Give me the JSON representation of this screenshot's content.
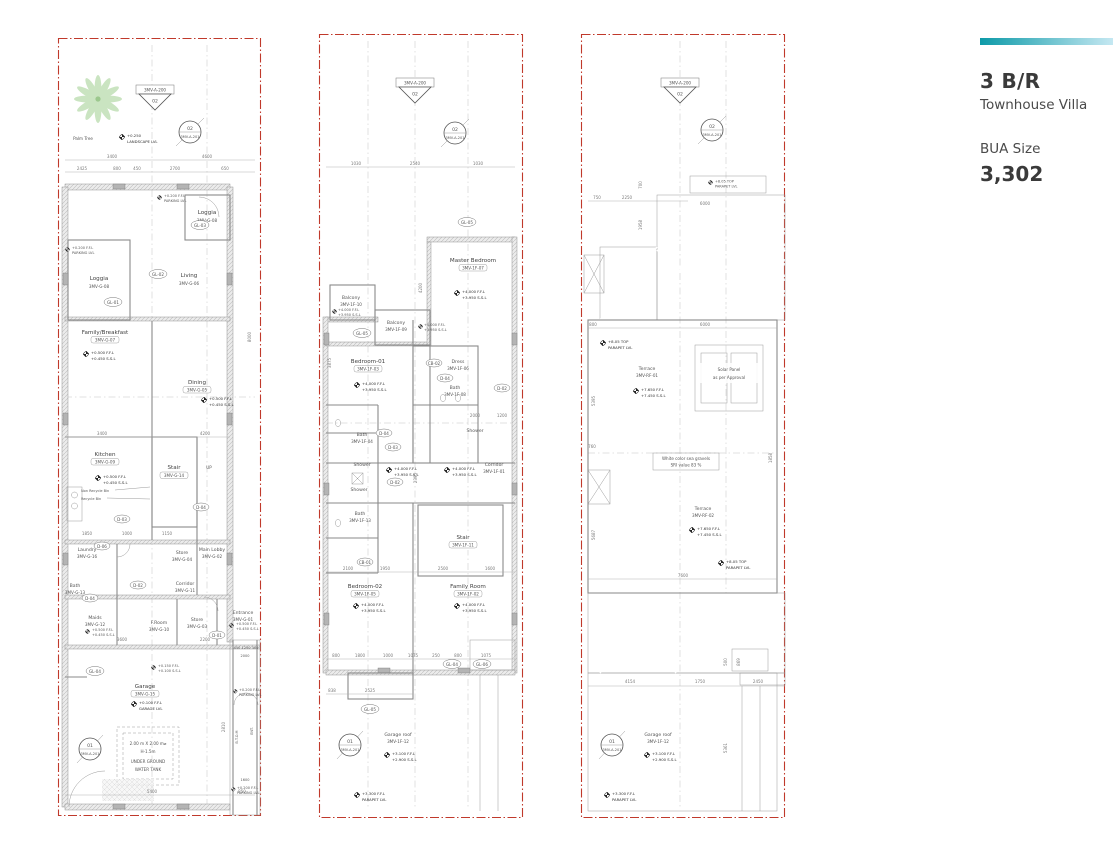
{
  "info_panel": {
    "title": "3 B/R",
    "subtitle": "Townhouse Villa",
    "bua_label": "BUA Size",
    "bua_value": "3,302",
    "accent_start": "#0d9aa8",
    "accent_end": "#c5e8f2",
    "boundary_color": "#c0392b",
    "tree_color": "#aed6a0"
  },
  "markers": {
    "section_ref": "3MV-A-200",
    "section_num": "02",
    "detail_top_num": "02",
    "detail_top_ref": "3MV-A-201",
    "detail_bottom_num": "01",
    "detail_bottom_ref": "3MV-A-201"
  },
  "levels": {
    "landscape_val": "+0.250",
    "landscape_lbl": "LANDSCAPE LVL",
    "parking_val": "+0.200 F.F.L",
    "parking_lbl": "PARKING LVL",
    "gf_ffl": "+0.500 F.F.L",
    "gf_ssl": "+0.450 S.S.L",
    "entry_ffl": "+0.150 F.F.L",
    "entry_ssl": "+0.100 S.S.L",
    "garage_ffl": "+0.100 F.F.L",
    "garage_lbl": "GARAGE LVL",
    "ff_ffl": "+4.000 F.F.L",
    "ff_ssl": "+3.950 S.S.L",
    "groof_ffl": "+3.100 F.F.L",
    "groof_ssl": "+2.900 S.S.L",
    "parapet_ffl": "+3.300 F.F.L",
    "parapet_lbl": "PARAPET LVL",
    "rf_ffl": "+7.650 F.F.L",
    "rf_ssl": "+7.450 S.S.L",
    "top_parapet_val": "+8.05 TOP",
    "top_parapet_lbl": "PARAPET LVL"
  },
  "ground": {
    "palm_tree": "Palm Tree",
    "rooms": {
      "loggia1": {
        "name": "Loggia",
        "code": "3MV-G-08"
      },
      "loggia2": {
        "name": "Loggia",
        "code": "3MV-G-08"
      },
      "living": {
        "name": "Living",
        "code": "3MV-G-06"
      },
      "family": {
        "name": "Family/Breakfast",
        "code": "3MV-G-07"
      },
      "dining": {
        "name": "Dining",
        "code": "3MV-G-05"
      },
      "kitchen": {
        "name": "Kitchen",
        "code": "3MV-G-09"
      },
      "stair": {
        "name": "Stair",
        "code": "3MV-G-14"
      },
      "laundry": {
        "name": "Laundry",
        "code": "3MV-G-16"
      },
      "store": {
        "name": "Store",
        "code": "3MV-G-04"
      },
      "lobby": {
        "name": "Main Lobby",
        "code": "3MV-G-02"
      },
      "corridor": {
        "name": "Corridor",
        "code": "3MV-G-11"
      },
      "bath": {
        "name": "Bath",
        "code": "3MV-G-13"
      },
      "maids": {
        "name": "Maids",
        "code": "3MV-G-12"
      },
      "froom": {
        "name": "F.Room",
        "code": "3MV-G-10"
      },
      "store2": {
        "name": "Store",
        "code": "3MV-G-03"
      },
      "entrance": {
        "name": "Entrance",
        "code": "3MV-G-01"
      },
      "garage": {
        "name": "Garage",
        "code": "3MV-G-15"
      }
    },
    "notes": {
      "up": "UP",
      "non_recycle": "Non Recycle Bin",
      "recycle": "Recycle Bin",
      "tank1": "2.00 m X 2.00 m⌀",
      "tank2": "H-1.5m",
      "tank3": "UNDER GROUND",
      "tank4": "WATER TANK",
      "btom": "B.T.O.M",
      "ent": "ENT."
    },
    "tags": {
      "gl01": "GL-01",
      "gl02": "GL-02",
      "gl03": "GL-03",
      "gl04": "GL-04",
      "d01": "D-01",
      "d02": "D-02",
      "d03": "D-03",
      "d04": "D-04",
      "d06": "D-06"
    },
    "dims": {
      "t1": "3400",
      "t2": "4600",
      "r1": "2425",
      "r2": "800",
      "r3": "450",
      "r4": "2700",
      "r5": "650",
      "v1": "8000",
      "m1": "3400",
      "m2": "4200",
      "k1": "1850",
      "k2": "1000",
      "k3": "1150",
      "b1": "3600",
      "b2": "2200",
      "dv1": "450",
      "dv2": "1250",
      "dv3": "300",
      "dv4": "2000",
      "dv5": "1600",
      "bot1": "5400",
      "bot2": "850",
      "v2": "2810"
    }
  },
  "first": {
    "rooms": {
      "balcony_top": {
        "name": "Balcony",
        "code": "3MV-1F-09"
      },
      "balcony_left": {
        "name": "Balcony",
        "code": "3MV-1F-10"
      },
      "master": {
        "name": "Master Bedroom",
        "code": "3MV-1F-07"
      },
      "bedroom1": {
        "name": "Bedroom-01",
        "code": "3MV-1F-03"
      },
      "dress": {
        "name": "Dress",
        "code": "3MV-1F-06"
      },
      "bath_top": {
        "name": "Bath",
        "code": "3MV-1F-08"
      },
      "shower_r": {
        "name": "Shower"
      },
      "bath_left": {
        "name": "Bath",
        "code": "3MV-1F-04"
      },
      "shower_l1": {
        "name": "Shower"
      },
      "shower_l2": {
        "name": "Shower"
      },
      "bath_ll": {
        "name": "Bath",
        "code": "3MV-1F-13"
      },
      "corridor": {
        "name": "Corridor",
        "code": "3MV-1F-01"
      },
      "stair": {
        "name": "Stair",
        "code": "3MV-1F-11"
      },
      "bedroom2": {
        "name": "Bedroom-02",
        "code": "3MV-1F-05"
      },
      "family": {
        "name": "Family Room",
        "code": "3MV-1F-02"
      },
      "garage_roof": {
        "name": "Garage roof",
        "code": "3MV-1F-12"
      }
    },
    "tags": {
      "gl05": "GL-05",
      "gl04": "GL-04",
      "gl06": "GL-06",
      "cb01": "CB-01",
      "cb02": "CB-02",
      "d02": "D-02",
      "d03": "D-03",
      "d04": "D-04"
    },
    "dims": {
      "t1": "1030",
      "t2": "2540",
      "t3": "1030",
      "s1": "2100",
      "s2": "1950",
      "s3": "2500",
      "s4": "1600",
      "w1": "800",
      "w2": "1800",
      "w3": "1000",
      "w4": "1075",
      "w5": "250",
      "w6": "800",
      "w7": "1075",
      "g1": "838",
      "g2": "2525",
      "v1": "3875",
      "v2": "2395",
      "v3": "4200",
      "b1": "2000",
      "b2": "1200"
    }
  },
  "roof": {
    "labels": {
      "terrace1": {
        "name": "Terrace",
        "code": "3MV-RF-01"
      },
      "terrace2": {
        "name": "Terrace",
        "code": "3MV-RF-02"
      },
      "solar1": "Solar Panel",
      "solar2": "as per Approval",
      "gravel1": "White color sea gravels",
      "gravel2": "SRI value 83 %",
      "garage_roof": {
        "name": "Garage roof",
        "code": "3MV-1F-12"
      }
    },
    "dims": {
      "t1": "750",
      "t2": "2250",
      "t3": "6000",
      "r1": "800",
      "r2": "6000",
      "v1": "700",
      "v2": "1958",
      "v3": "5395",
      "v4": "5687",
      "v5": "760",
      "d1": "7600",
      "b1": "4154",
      "b2": "1750",
      "b3": "2450",
      "v6": "5361",
      "v7": "1858",
      "n1": "500",
      "n2": "869"
    }
  }
}
